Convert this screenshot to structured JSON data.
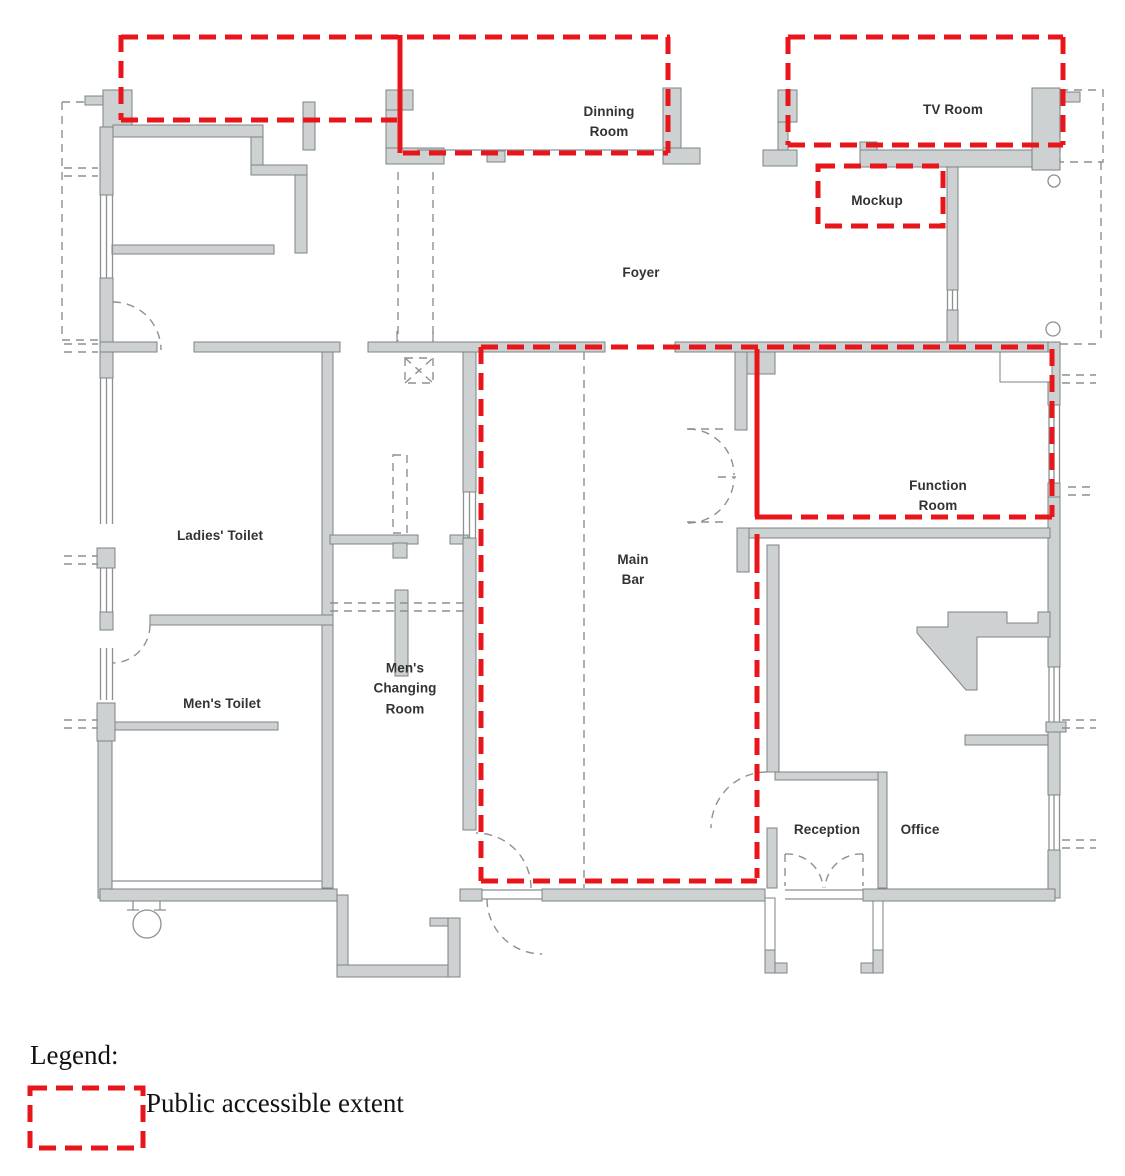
{
  "title": "Floor plan — public accessible extent",
  "rooms": {
    "dinning": "Dinning\nRoom",
    "tv": "TV Room",
    "mockup": "Mockup",
    "foyer": "Foyer",
    "ladies_toilet": "Ladies' Toilet",
    "mens_toilet": "Men's Toilet",
    "mens_changing": "Men's\nChanging\nRoom",
    "main_bar": "Main\nBar",
    "function_room": "Function\nRoom",
    "reception": "Reception",
    "office": "Office"
  },
  "legend": {
    "title": "Legend:",
    "items": [
      {
        "symbol": "red-dashed-rectangle",
        "label": "Public accessible extent"
      }
    ]
  },
  "colors": {
    "accent_red": "#e8151b",
    "wall_fill": "#cdd1d2",
    "wall_stroke": "#7d8384",
    "line_grey": "#8b9193",
    "text": "#333333"
  }
}
